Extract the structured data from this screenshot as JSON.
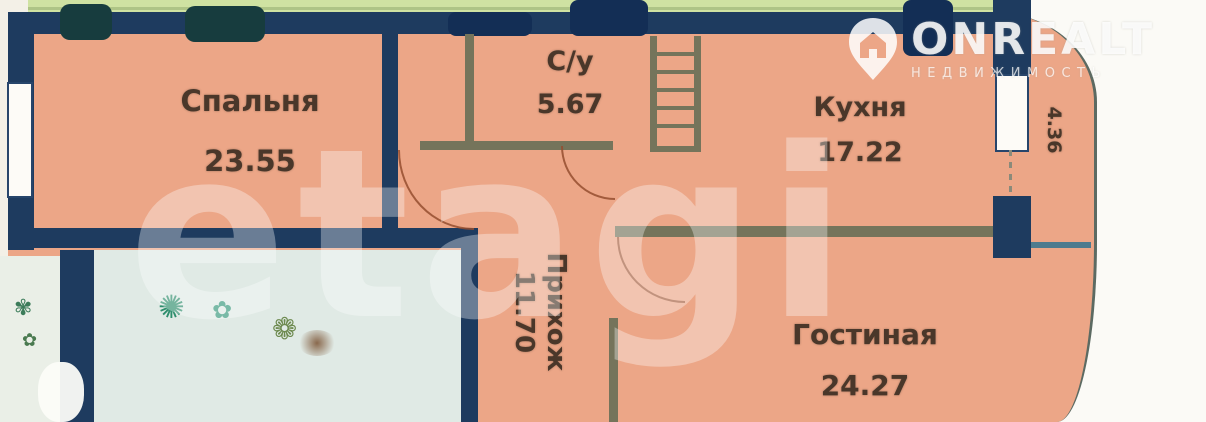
{
  "floorplan": {
    "rooms": {
      "bedroom": {
        "label": "Спальня",
        "area": "23.55"
      },
      "bathroom": {
        "label": "С/у",
        "area": "5.67"
      },
      "kitchen": {
        "label": "Кухня",
        "area": "17.22"
      },
      "hallway": {
        "label": "Прихож",
        "area": "11.70"
      },
      "living": {
        "label": "Гостиная",
        "area": "24.27"
      },
      "balcony": {
        "label": "",
        "area": "4.36"
      }
    },
    "decor_glyphs": {
      "plant1": "✺",
      "plant2": "✿",
      "plant3": "❁",
      "strip_plant": "✾"
    },
    "palette": {
      "room_fill": "#eca687",
      "wall_navy": "#1e3b5f",
      "wall_olive": "#75745b",
      "green_strip": "#cfe2a2",
      "teal_room_fill": "#e0eae5",
      "label_brown": "#4a372a",
      "background": "#f3f0e7"
    }
  },
  "watermarks": {
    "etagi": {
      "text": "etagi"
    },
    "onrealt": {
      "brand": "ONREALT",
      "subtitle": "НЕДВИЖИМОСТЬ",
      "icon": "house-pin-icon"
    }
  }
}
